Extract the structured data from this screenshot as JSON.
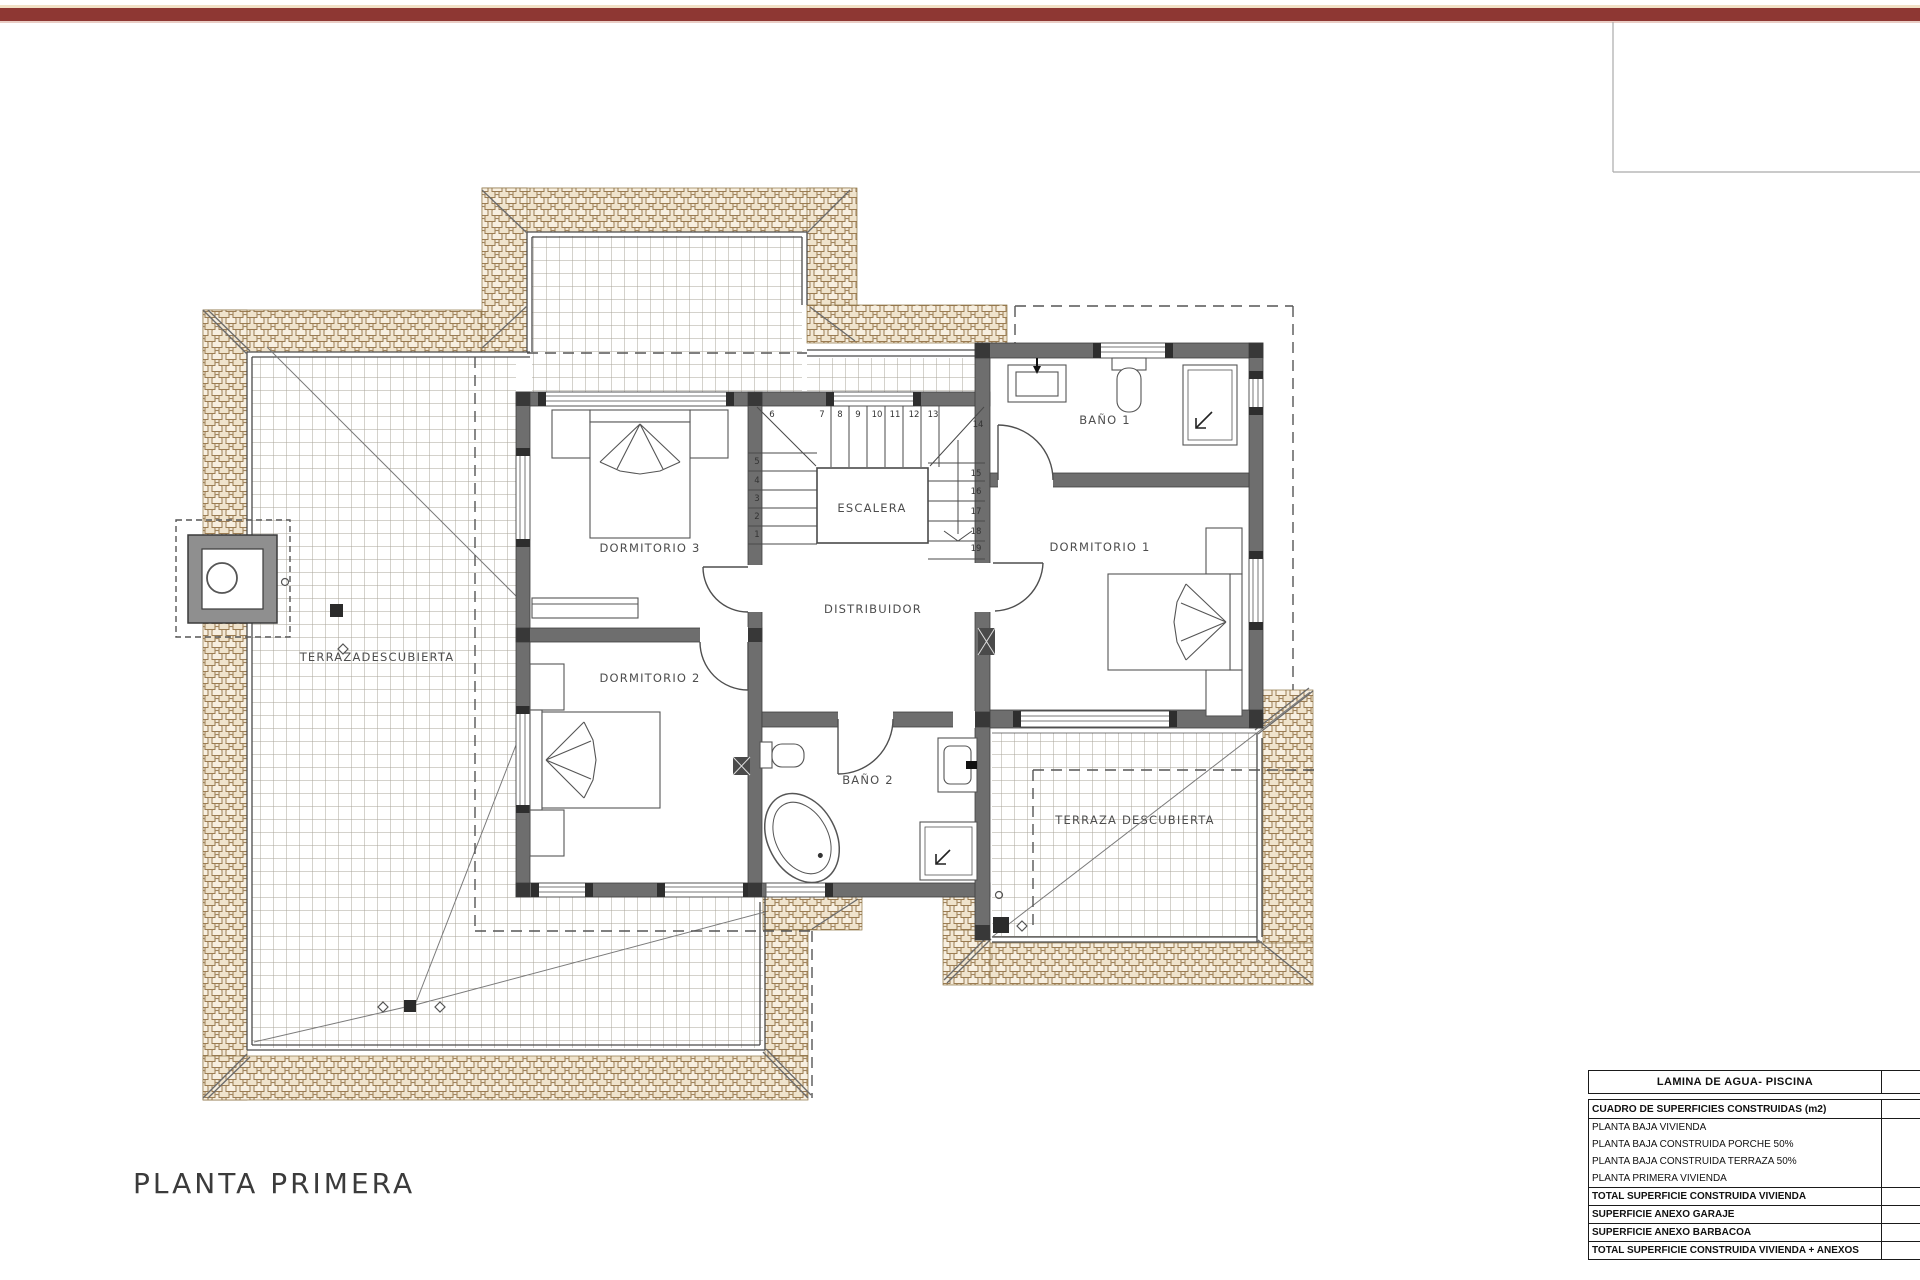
{
  "meta": {
    "accent_bar_color": "#8e3733",
    "tile_fill": "#f2e8d6",
    "tile_line": "#9b7c52",
    "wall_color": "#6e6e6e",
    "sheet_bg": "#ffffff"
  },
  "title_block": {
    "plan_title": "PLANTA PRIMERA"
  },
  "plan": {
    "rooms": {
      "dormitorio3": "DORMITORIO 3",
      "dormitorio2": "DORMITORIO 2",
      "dormitorio1": "DORMITORIO 1",
      "bano1": "BAÑO 1",
      "bano2": "BAÑO 2",
      "escalera": "ESCALERA",
      "distribuidor": "DISTRIBUIDOR",
      "terraza_izquierda": "TERRAZADESCUBIERTA",
      "terraza_derecha": "TERRAZA DESCUBIERTA"
    },
    "stairs": {
      "numbers": [
        "1",
        "2",
        "3",
        "4",
        "5",
        "6",
        "7",
        "8",
        "9",
        "10",
        "11",
        "12",
        "13",
        "14",
        "15",
        "16",
        "17",
        "18",
        "19"
      ]
    }
  },
  "tables": {
    "lamina": {
      "title": "LAMINA DE AGUA- PISCINA"
    },
    "superficies": {
      "header": "CUADRO DE SUPERFICIES CONSTRUIDAS (m2)",
      "rows": [
        {
          "label": "PLANTA BAJA VIVIENDA"
        },
        {
          "label": "PLANTA BAJA CONSTRUIDA PORCHE 50%"
        },
        {
          "label": "PLANTA BAJA CONSTRUIDA TERRAZA 50%"
        },
        {
          "label": "PLANTA PRIMERA VIVIENDA"
        },
        {
          "label": "TOTAL SUPERFICIE CONSTRUIDA VIVIENDA"
        },
        {
          "label": "SUPERFICIE ANEXO GARAJE"
        },
        {
          "label": "SUPERFICIE ANEXO BARBACOA"
        },
        {
          "label": "TOTAL SUPERFICIE CONSTRUIDA VIVIENDA + ANEXOS"
        }
      ]
    }
  }
}
